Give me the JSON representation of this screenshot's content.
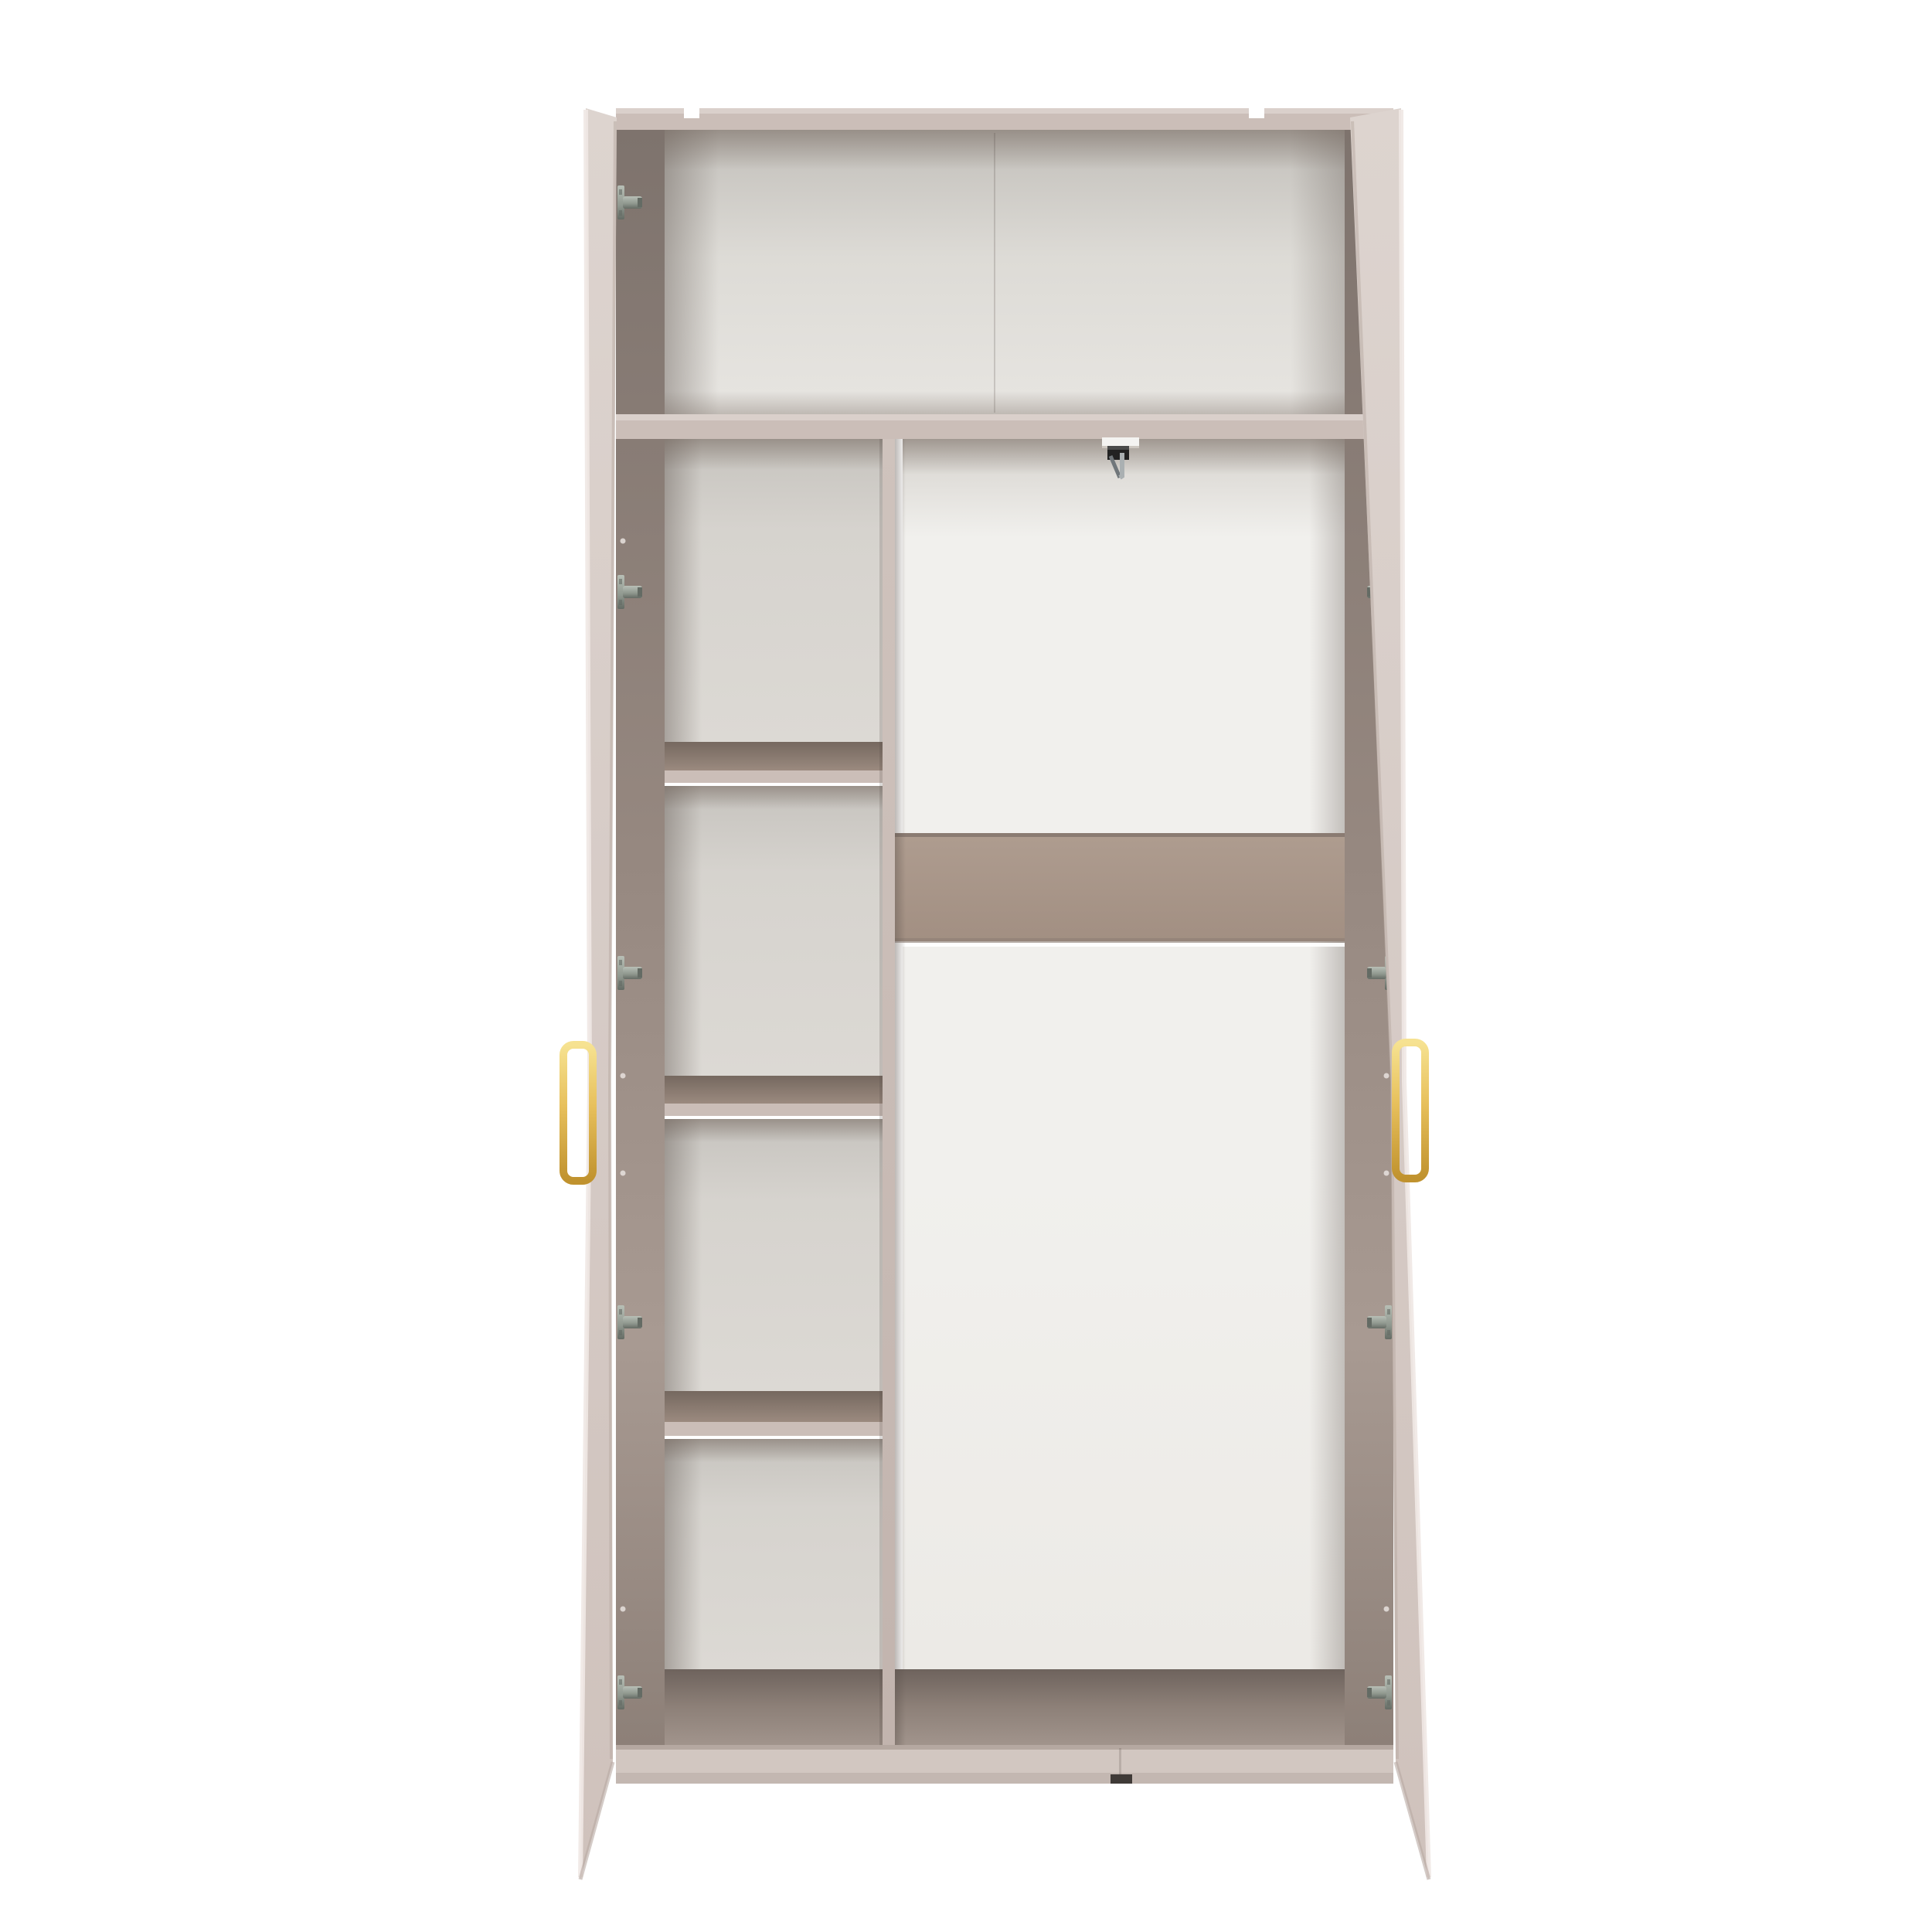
{
  "meta": {
    "description": "Product render of a tall open two-door wardrobe in a greige cashmere finish with gold handles, showing the interior: a full-width top shelf, a left column of four cubby shelves, an open hanging section on the right with a horizontal support rail, five hinge plates on each side wall, and a metal hanging hook under the top shelf."
  },
  "structure": {
    "doors": 2,
    "left_cubbies": 4,
    "hinges_per_side": 5,
    "top_notches": 2,
    "handle_finish": "gold",
    "support_rail": "horizontal band in hanging section"
  },
  "colors": {
    "bg": "#ffffff",
    "door_face_light": "#ddd4cf",
    "door_face": "#d6cbc6",
    "door_face_dark": "#cfc2bc",
    "door_edge_highlight": "#efe8e4",
    "door_edge_shadow": "#b7a9a2",
    "frame_edge": "#cbbeb8",
    "frame_edge_highlight": "#dad0cb",
    "wall_top": "#7e736d",
    "wall_mid": "#968880",
    "wall_light": "#a89a92",
    "wall_bottom": "#8d8078",
    "top_back_dark": "#c2bfba",
    "top_back": "#dddbd6",
    "top_back_light": "#e7e5e1",
    "cubby_back_dark": "#c6c3be",
    "cubby_back": "#d6d3ce",
    "cubby_back_light": "#dcd9d4",
    "right_back_shade": "#d5d2cd",
    "right_back": "#f1f0ed",
    "right_back_dim": "#eceae6",
    "band_top": "#ae9c8f",
    "band_bottom": "#a28f82",
    "band_edge_dark": "#8a7b72",
    "shelf_recess_dark": "#75685f",
    "shelf_recess": "#9b8a7f",
    "floor_dark": "#6e635d",
    "floor_mid": "#8d8078",
    "floor_light": "#a1948c",
    "plinth": "#d2c7c1",
    "plinth_line": "#b5a8a1",
    "plinth_shade": "#c3b7b1",
    "notch_dark": "#3f3a37",
    "divider_light": "#cfc3bd",
    "divider_dark": "#c2b4ae",
    "seam": "rgba(80,70,65,0.20)",
    "vignette": "#5a504a",
    "gold_light": "#f6e291",
    "gold": "#e7c05c",
    "gold_dark": "#c0922e",
    "metal_light": "#b8bfb6",
    "metal": "#8f978e",
    "metal_dark": "#646b64",
    "hook_plate": "#f4f3f1",
    "hook_plate_shadow": "#cdc7c0",
    "hook_black": "#222222",
    "hook_black_hi": "#4a4a4a",
    "chrome": "#aab0b2",
    "chrome_dark": "#70767a",
    "screw_dot": "#e8e2de"
  }
}
